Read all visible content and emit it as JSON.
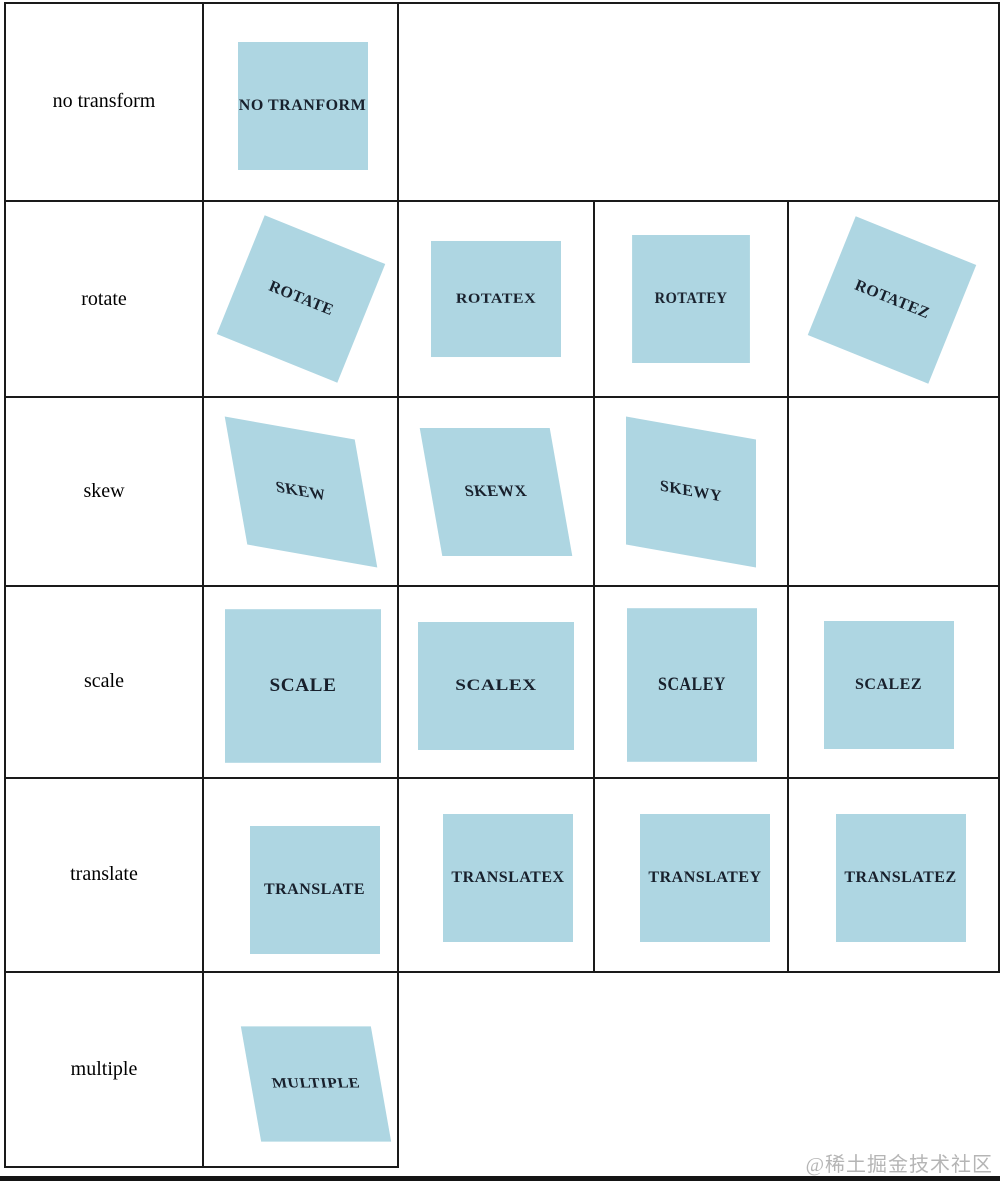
{
  "watermark": "@稀土掘金技术社区",
  "colors": {
    "box_background": "#aed6e2",
    "box_text": "#18202c",
    "table_border": "#1a1a1a",
    "row_label_text": "#000000",
    "watermark_text": "#b5b5b5",
    "bottom_band": "#151515",
    "page_background": "#ffffff"
  },
  "rows": [
    {
      "label": "no transform",
      "items": [
        {
          "id": "no-transform",
          "label": "NO TRANFORM"
        }
      ]
    },
    {
      "label": "rotate",
      "items": [
        {
          "id": "rotate",
          "label": "ROTATE"
        },
        {
          "id": "rotatex",
          "label": "ROTATEX"
        },
        {
          "id": "rotatey",
          "label": "ROTATEY"
        },
        {
          "id": "rotatez",
          "label": "ROTATEZ"
        }
      ]
    },
    {
      "label": "skew",
      "items": [
        {
          "id": "skew",
          "label": "SKEW"
        },
        {
          "id": "skewx",
          "label": "SKEWX"
        },
        {
          "id": "skewy",
          "label": "SKEWY"
        }
      ]
    },
    {
      "label": "scale",
      "items": [
        {
          "id": "scale",
          "label": "SCALE"
        },
        {
          "id": "scalex",
          "label": "SCALEX"
        },
        {
          "id": "scaley",
          "label": "SCALEY"
        },
        {
          "id": "scalez",
          "label": "SCALEZ"
        }
      ]
    },
    {
      "label": "translate",
      "items": [
        {
          "id": "translate",
          "label": "TRANSLATE"
        },
        {
          "id": "translatex",
          "label": "TRANSLATEX"
        },
        {
          "id": "translatey",
          "label": "TRANSLATEY"
        },
        {
          "id": "translatez",
          "label": "TRANSLATEZ"
        }
      ]
    },
    {
      "label": "multiple",
      "items": [
        {
          "id": "multiple",
          "label": "MULTIPLE"
        }
      ]
    }
  ]
}
